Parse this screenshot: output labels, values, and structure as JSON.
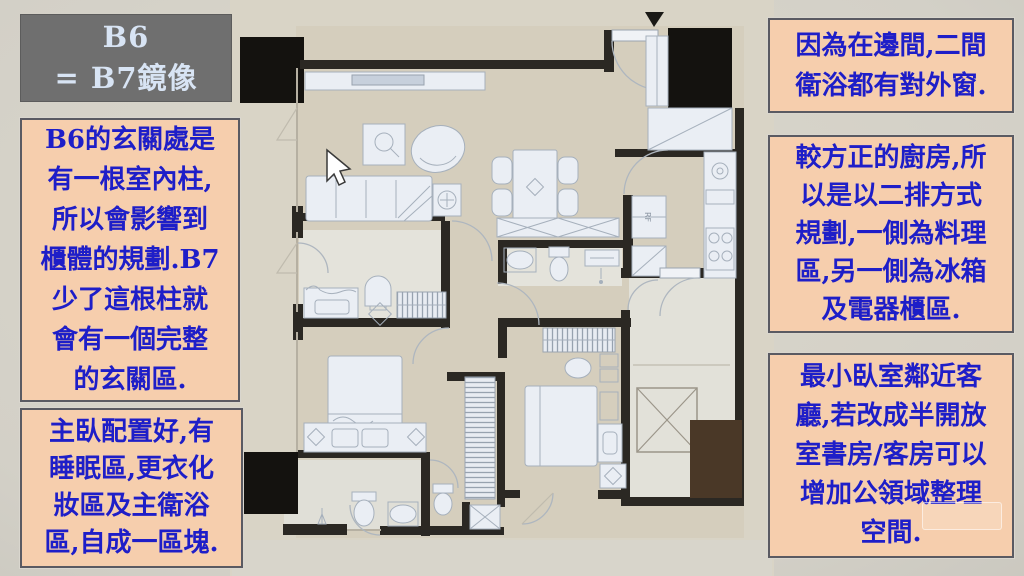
{
  "title": {
    "text": "B6\n= B7鏡像"
  },
  "notes_left": [
    {
      "id": "entry-column",
      "text": "B6的玄關處是\n有一根室內柱,\n所以會影響到\n櫃體的規劃.B7\n少了這根柱就\n會有一個完整\n的玄關區."
    },
    {
      "id": "master-suite",
      "text": "主臥配置好,有\n睡眠區,更衣化\n妝區及主衛浴\n區,自成一區塊."
    }
  ],
  "notes_right": [
    {
      "id": "bath-windows",
      "text": "因為在邊間,二間\n衛浴都有對外窗."
    },
    {
      "id": "kitchen-two-rows",
      "text": "較方正的廚房,所\n以是以二排方式\n規劃,一側為料理\n區,另一側為冰箱\n及電器櫃區."
    },
    {
      "id": "small-bedroom",
      "text": "最小臥室鄰近客\n廳,若改成半開放\n室書房/客房可以\n增加公領域整理\n空間."
    }
  ],
  "floorplan": {
    "fridge_label": "RF"
  },
  "colors": {
    "note_bg": "#f6cead",
    "note_border": "#5a5a62",
    "note_text": "#1e1ec8",
    "title_bg": "#6f6f6f",
    "title_text": "#d8e4f4",
    "wall": "#2b2823",
    "floor": "#d5cebd",
    "furniture": "#eaeef4"
  }
}
